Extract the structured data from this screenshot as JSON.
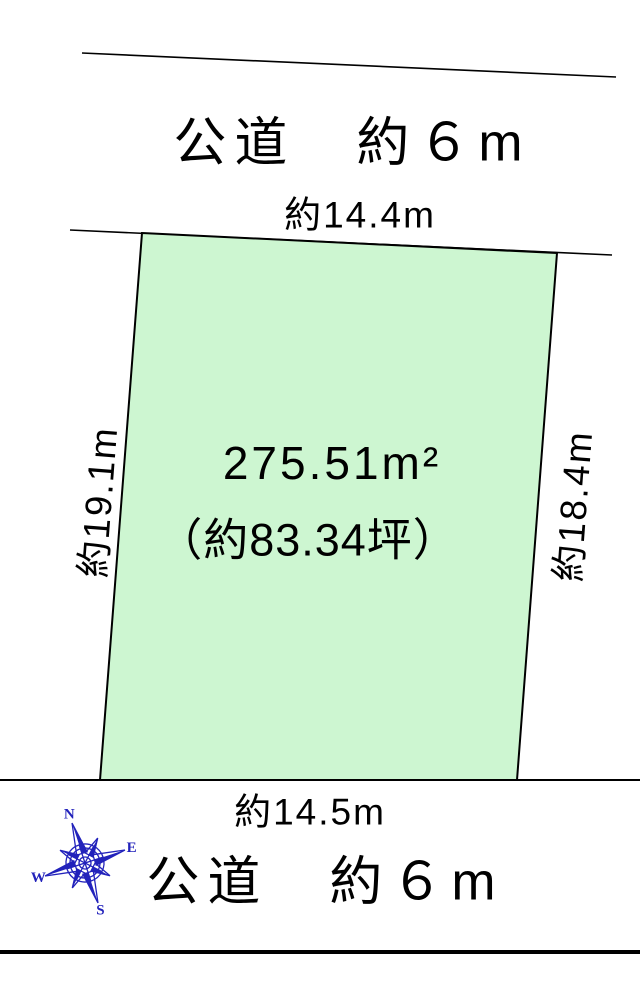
{
  "theme": {
    "parcel_fill": "#cdf6d1",
    "compass_blue": "#2222bb",
    "ink": "#000000"
  },
  "top_road": {
    "label": "公道　約６m"
  },
  "bottom_road": {
    "label": "公道　約６m"
  },
  "parcel": {
    "area_m2": "275.51m²",
    "area_tsubo": "（約83.34坪）",
    "dim_top": "約14.4m",
    "dim_left": "約19.1m",
    "dim_right": "約18.4m",
    "dim_bottom": "約14.5m"
  },
  "compass": {
    "n": "N",
    "e": "E",
    "s": "S",
    "w": "W"
  }
}
